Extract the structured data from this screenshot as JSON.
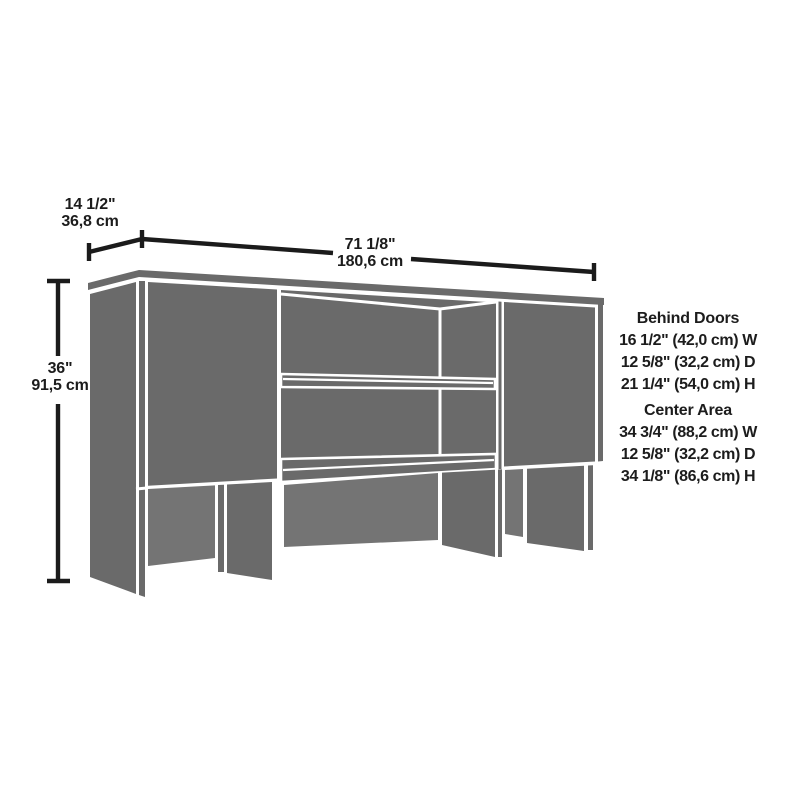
{
  "dimensions": {
    "depth": {
      "imperial": "14 1/2\"",
      "metric": "36,8 cm"
    },
    "width": {
      "imperial": "71 1/8\"",
      "metric": "180,6 cm"
    },
    "height": {
      "imperial": "36\"",
      "metric": "91,5 cm"
    }
  },
  "specs": {
    "behind_doors": {
      "title": "Behind Doors",
      "lines": [
        "16 1/2\" (42,0 cm) W",
        "12 5/8\" (32,2 cm) D",
        "21 1/4\" (54,0 cm) H"
      ]
    },
    "center_area": {
      "title": "Center Area",
      "lines": [
        "34 3/4\" (88,2 cm) W",
        "12 5/8\" (32,2 cm) D",
        "34 1/8\" (86,6 cm) H"
      ]
    }
  },
  "colors": {
    "furniture_gray": "#6a6a6a",
    "back_panel_gray": "#747474",
    "dimension_line_black": "#1b1b1b",
    "background": "#ffffff"
  }
}
